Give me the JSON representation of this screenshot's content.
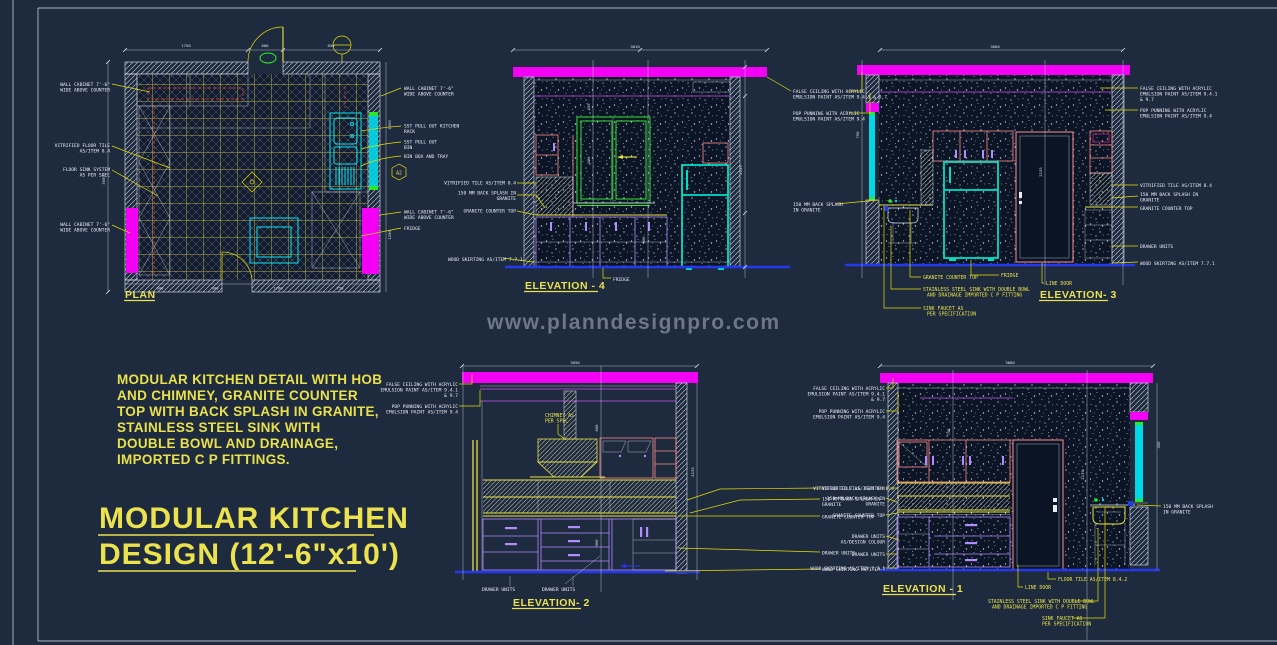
{
  "watermark": "www.planndesignpro.com",
  "note": [
    "MODULAR KITCHEN DETAIL WITH HOB",
    "AND CHIMNEY, GRANITE COUNTER",
    "TOP WITH BACK SPLASH IN GRANITE,",
    "STAINLESS STEEL SINK WITH",
    "DOUBLE BOWL AND DRAINAGE,",
    "IMPORTED C P FITTINGS."
  ],
  "title": [
    "MODULAR KITCHEN",
    "DESIGN (12'-6\"x10')"
  ],
  "plan": {
    "title": "PLAN",
    "left": [
      "WALL CABINET 7'-6\"",
      "WIDE ABOVE COUNTER",
      "VITRIFIED FLOOR TILE",
      "AS/ITEM 8.4",
      "FLOOR SINK SYSTEM",
      "AS PER SPEC",
      "WALL CABINET 7'-6\"",
      "WIDE ABOVE COUNTER"
    ],
    "right": [
      "WALL CABINET 7'-6\"",
      "WIDE ABOVE COUNTER",
      "SST PULL OUT KITCHEN",
      "RACK",
      "SST PULL OUT",
      "BIN",
      "BIN BOX AND TRAY",
      "WALL CABINET 7'-6\"",
      "WIDE ABOVE COUNTER",
      "FRIDGE"
    ],
    "marker": "A2",
    "dims_top": [
      "1750",
      "600",
      "850"
    ],
    "dims_bottom": [
      "600",
      "900",
      "1760",
      "750"
    ],
    "dims_left": [
      "3050"
    ],
    "dims_right": [
      "1050",
      "1200"
    ]
  },
  "elev4": {
    "title": "ELEVATION - 4",
    "left": [
      "VITRIFIED TILE AS/ITEM 8.4",
      "150 MM BACK SPLASH IN",
      "GRANITE",
      "GRANITE COUNTER TOP",
      "WOOD SKIRTING AS/ITEM 7.7.1"
    ],
    "bottom": [
      "FRIDGE"
    ],
    "dims": [
      "3810",
      "450",
      "600",
      "900",
      "2135"
    ]
  },
  "elev3": {
    "title": "ELEVATION- 3",
    "left": [
      "FALSE CEILING WITH ACRYLIC",
      "EMULSION PAINT AS/ITEM 9.4.1 & 9.7",
      "POP PUNNING WITH ACRYLIC",
      "EMULSION PAINT AS/ITEM 9.4",
      "150 MM BACK SPLASH",
      "IN GRANITE"
    ],
    "right": [
      "FALSE CEILING WITH ACRYLIC",
      "EMULSION PAINT AS/ITEM 9.4.1",
      "& 9.7",
      "POP PUNNING WITH ACRYLIC",
      "EMULSION PAINT AS/ITEM 9.4",
      "VITRIFIED TILE AS/ITEM 8.4",
      "150 MM BACK SPLASH IN",
      "GRANITE",
      "GRANITE COUNTER TOP",
      "DRAWER UNITS",
      "WOOD SKIRTING AS/ITEM 7.7.1"
    ],
    "bottom": [
      "GRANITE COUNTER TOP",
      "FRIDGE",
      "LINE DOOR",
      "STAINLESS STEEL SINK WITH DOUBLE BOWL",
      "AND DRAINAGE IMPORTED C P FITTING",
      "SINK FAUCET AS",
      "PER SPECIFICATION"
    ],
    "dims": [
      "3660",
      "750",
      "2135"
    ]
  },
  "elev2": {
    "title": "ELEVATION- 2",
    "left": [
      "FALSE CEILING WITH ACRYLIC",
      "EMULSION PAINT AS/ITEM 9.4.1",
      "& 9.7",
      "POP PUNNING WITH ACRYLIC",
      "EMULSION PAINT AS/ITEM 9.4"
    ],
    "chimney": [
      "CHIMNEY AS",
      "PER SPEC"
    ],
    "right": [
      "VITRIFIED TILE AS/ITEM 8.4",
      "150 MM BACK SPLASH IN",
      "GRANITE",
      "GRANITE COUNTER TOP",
      "DRAWER UNITS",
      "WOOD SKIRTING AS/ITEM 7.7.1"
    ],
    "bottom": [
      "DRAWER UNITS",
      "DRAWER UNITS"
    ],
    "dims": [
      "3050",
      "600",
      "900",
      "2135"
    ]
  },
  "elev1": {
    "title": "ELEVATION - 1",
    "left": [
      "FALSE CEILING WITH ACRYLIC",
      "EMULSION PAINT AS/ITEM 9.4.1",
      "& 9.7",
      "POP PUNNING WITH ACRYLIC",
      "EMULSION PAINT AS/ITEM 9.4",
      "VITRIFIED TILE AS/ITEM 8.4",
      "150 MM BACK SPLASH IN",
      "GRANITE",
      "GRANITE COUNTER TOP",
      "DRAWER UNITS",
      "AS/DESIGN COLOUR",
      "DRAWER UNITS",
      "WOOD SKIRTING AS/ITEM 7.7.1"
    ],
    "right": [
      "150 MM BACK SPLASH",
      "IN GRANITE"
    ],
    "bottom": [
      "LINE DOOR",
      "FLOOR TILE AS/ITEM 8.4.2",
      "STAINLESS STEEL SINK WITH DOUBLE BOWL",
      "AND DRAINAGE IMPORTED C P FITTING",
      "SINK FAUCET AS",
      "PER SPECIFICATION"
    ],
    "dims": [
      "3660",
      "750",
      "2135",
      "450"
    ]
  }
}
